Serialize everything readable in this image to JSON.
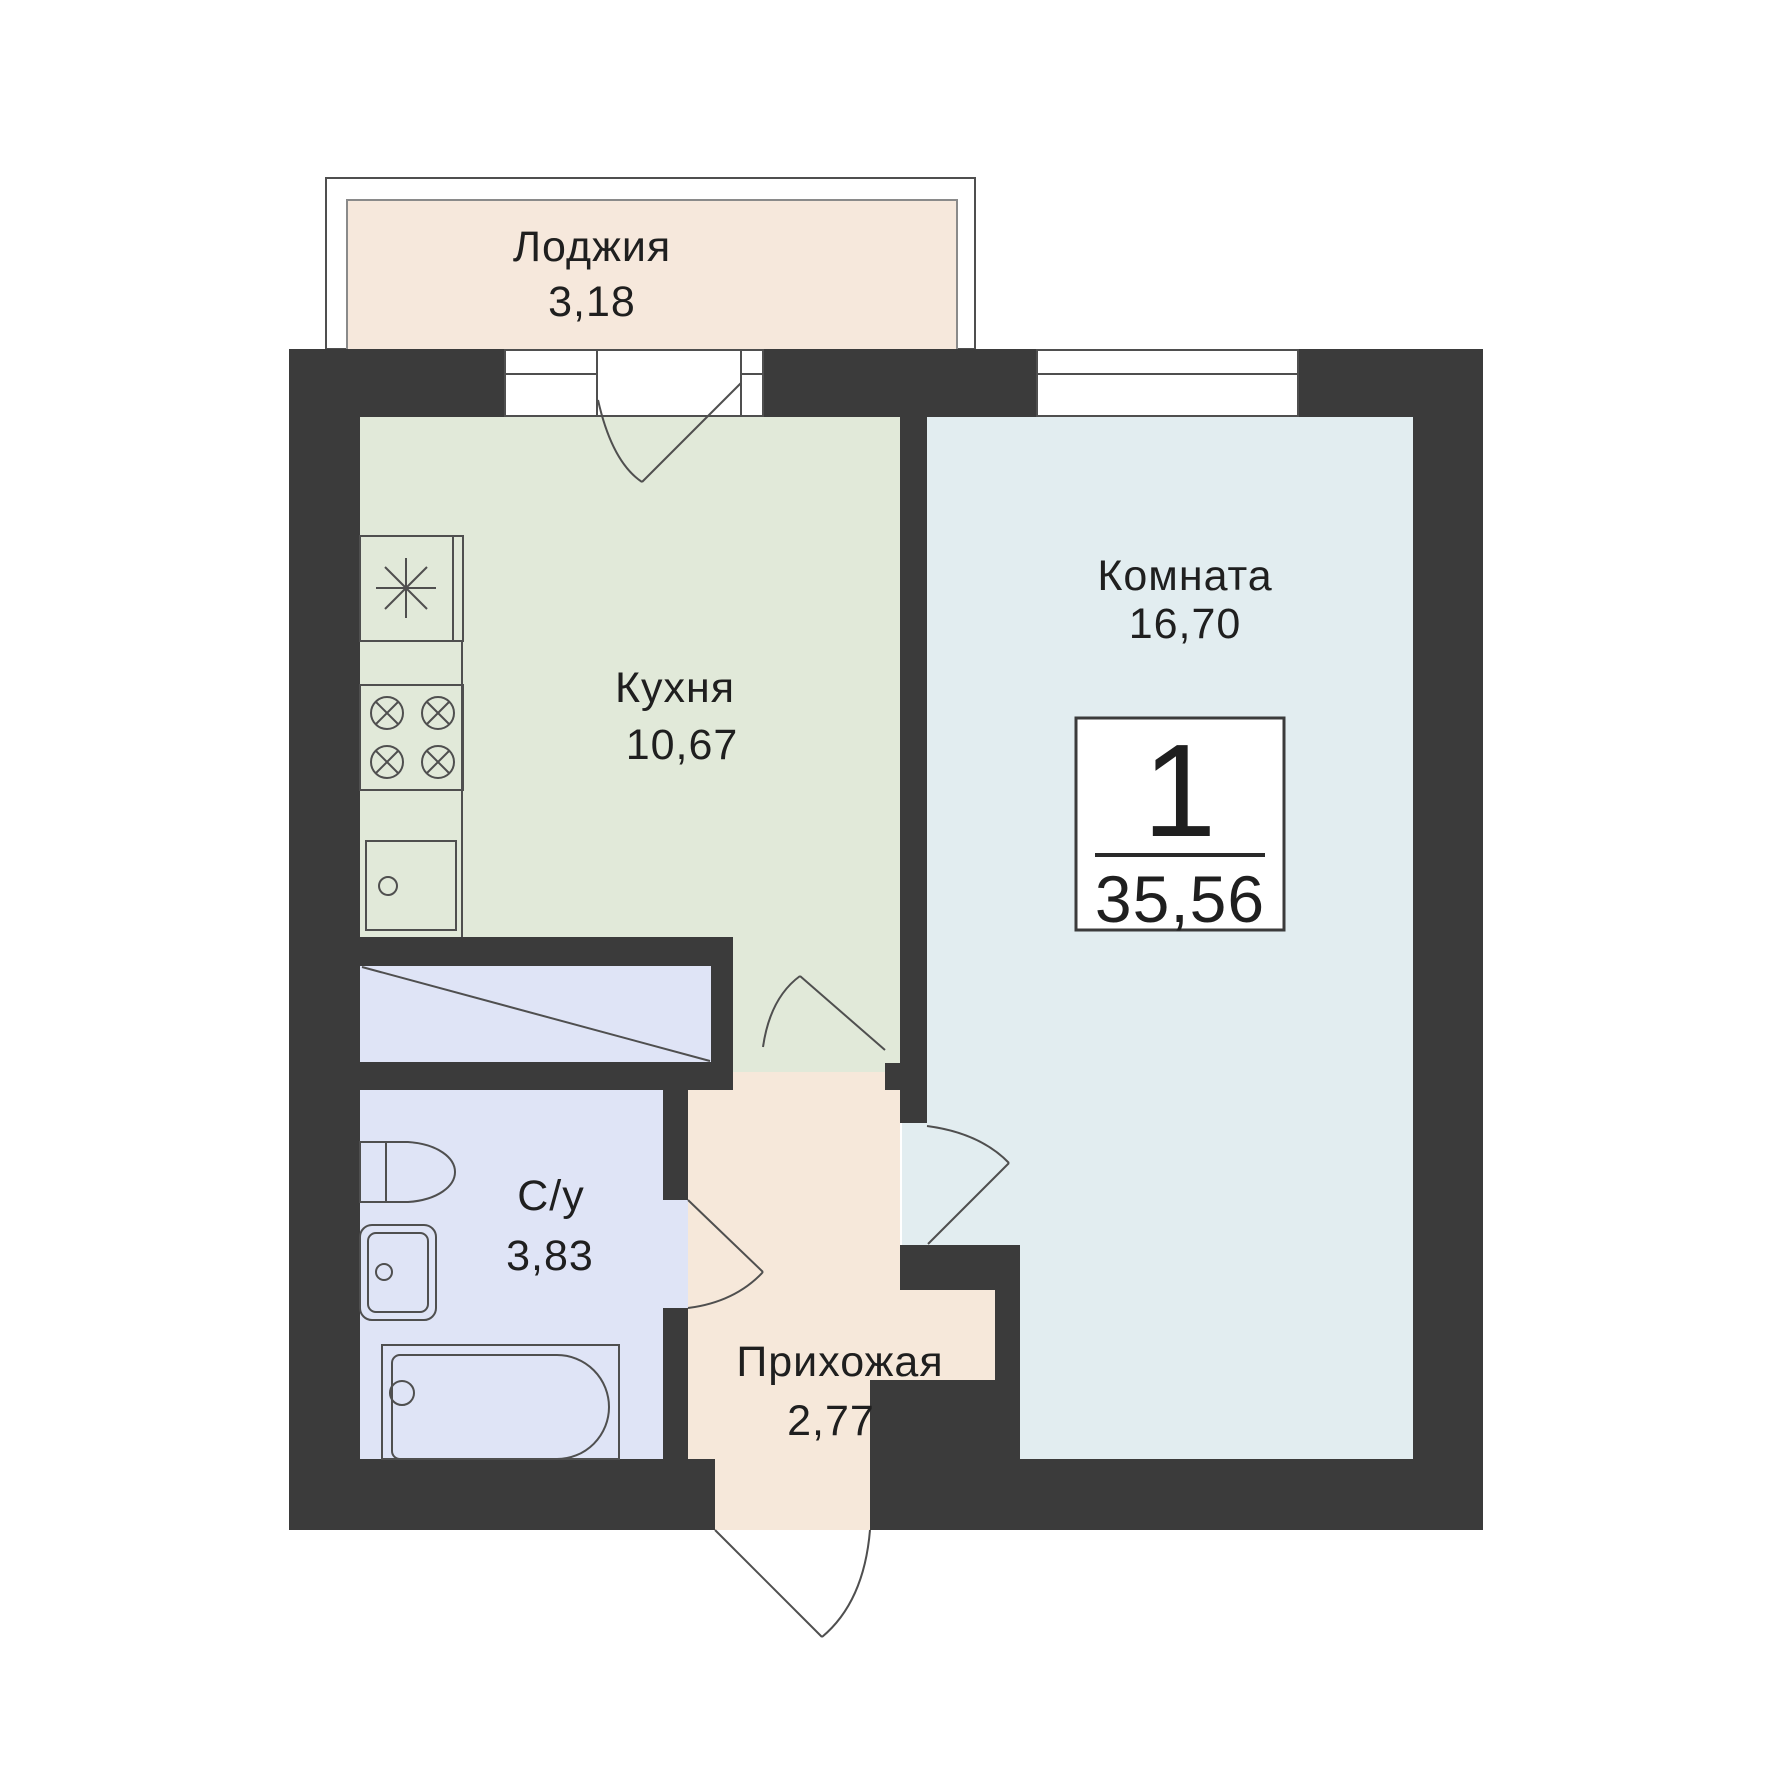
{
  "plan": {
    "badge": {
      "rooms_count": "1",
      "total_area": "35,56"
    },
    "rooms": [
      {
        "id": "loggia",
        "label": "Лоджия",
        "area": "3,18"
      },
      {
        "id": "kitchen",
        "label": "Кухня",
        "area": "10,67"
      },
      {
        "id": "living-room",
        "label": "Комната",
        "area": "16,70"
      },
      {
        "id": "bathroom",
        "label": "С/у",
        "area": "3,83"
      },
      {
        "id": "hallway",
        "label": "Прихожая",
        "area": "2,77"
      }
    ],
    "fixtures": [
      "fridge",
      "stove",
      "kitchen-sink",
      "wardrobe",
      "toilet",
      "washbasin",
      "bathtub"
    ],
    "colors": {
      "wall": "#3b3b3b",
      "line": "#4f4f4f",
      "loggia": "#f6e8dc",
      "kitchen": "#e1e9d9",
      "room": "#e2edf0",
      "wet": "#dfe4f6",
      "hallway": "#f6e8da",
      "badge_bg": "#ffffff",
      "text": "#1f1f1f"
    }
  }
}
